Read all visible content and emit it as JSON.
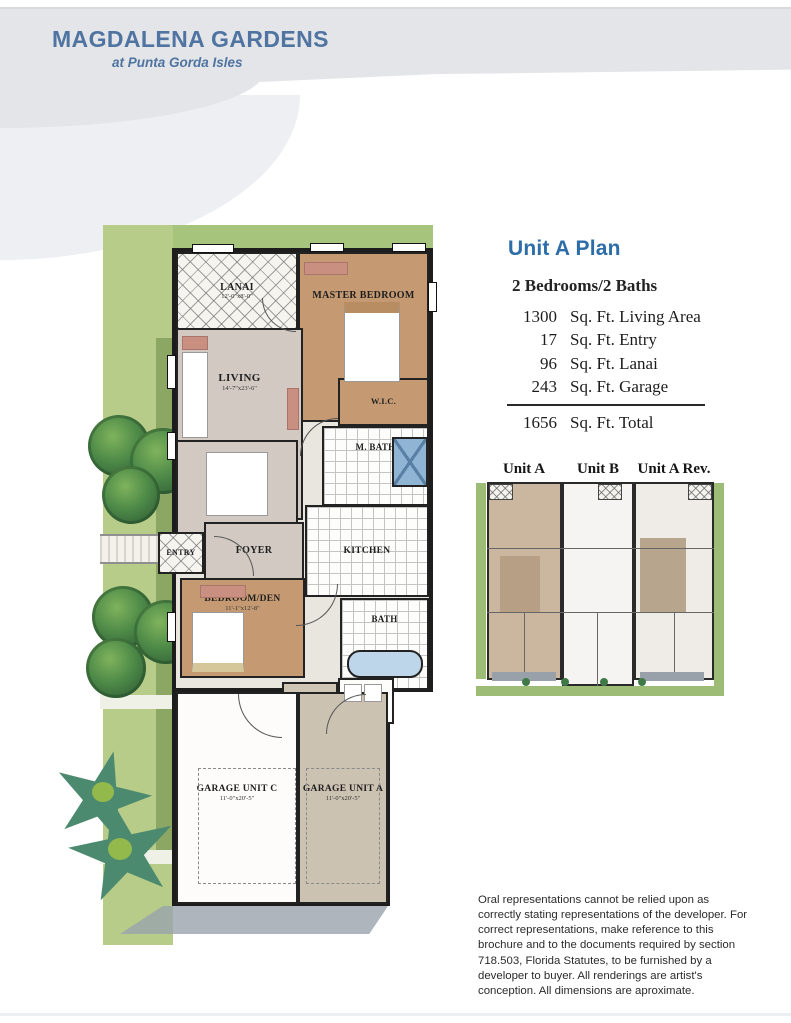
{
  "header": {
    "title": "MAGDALENA GARDENS",
    "subtitle": "at Punta Gorda Isles"
  },
  "unit_panel": {
    "title": "Unit A Plan",
    "beds_baths": "2 Bedrooms/2 Baths",
    "areas": [
      {
        "value": "1300",
        "label": "Sq. Ft. Living Area"
      },
      {
        "value": "17",
        "label": "Sq. Ft. Entry"
      },
      {
        "value": "96",
        "label": "Sq. Ft. Lanai"
      },
      {
        "value": "243",
        "label": "Sq. Ft. Garage"
      }
    ],
    "total": {
      "value": "1656",
      "label": "Sq. Ft. Total"
    }
  },
  "mini_plan": {
    "units": [
      "Unit A",
      "Unit B",
      "Unit A Rev."
    ]
  },
  "floor_plan": {
    "rooms": {
      "lanai": {
        "label": "LANAI",
        "dim": "12'-0\"x8'-0\""
      },
      "master": {
        "label": "MASTER BEDROOM",
        "dim": "14'-4\"x12'-10\""
      },
      "living": {
        "label": "LIVING",
        "dim": "14'-7\"x23'-6\""
      },
      "wic": {
        "label": "W.I.C.",
        "dim": ""
      },
      "mbath": {
        "label": "M. BATH",
        "dim": ""
      },
      "dining": {
        "label": "DINING",
        "dim": ""
      },
      "kitchen": {
        "label": "KITCHEN",
        "dim": ""
      },
      "entry": {
        "label": "ENTRY",
        "dim": ""
      },
      "foyer": {
        "label": "FOYER",
        "dim": ""
      },
      "bedroom_den": {
        "label": "BEDROOM/DEN",
        "dim": "11'-1\"x12'-8\""
      },
      "bath": {
        "label": "BATH",
        "dim": ""
      },
      "stor": {
        "label": "STOR.",
        "dim": ""
      },
      "utility": {
        "label": "UTILITY",
        "dim": ""
      },
      "garage_c": {
        "label": "GARAGE UNIT C",
        "dim": "11'-0\"x20'-5\""
      },
      "garage_a": {
        "label": "GARAGE UNIT A",
        "dim": "11'-0\"x20'-5\""
      }
    }
  },
  "disclaimer": "Oral representations cannot be relied upon as correctly stating representations of the developer. For correct representations, make reference to this brochure and to the documents required by section 718.503, Florida Statutes, to be furnished by a developer to buyer. All renderings are artist's conception. All dimensions are aproximate.",
  "colors": {
    "header_text": "#4f74a1",
    "unit_title": "#2d6da8",
    "plan_green": "#a7c47d",
    "room_tan": "#c59a73",
    "room_gray": "#d1c9c2",
    "wall": "#1d1d1d"
  }
}
